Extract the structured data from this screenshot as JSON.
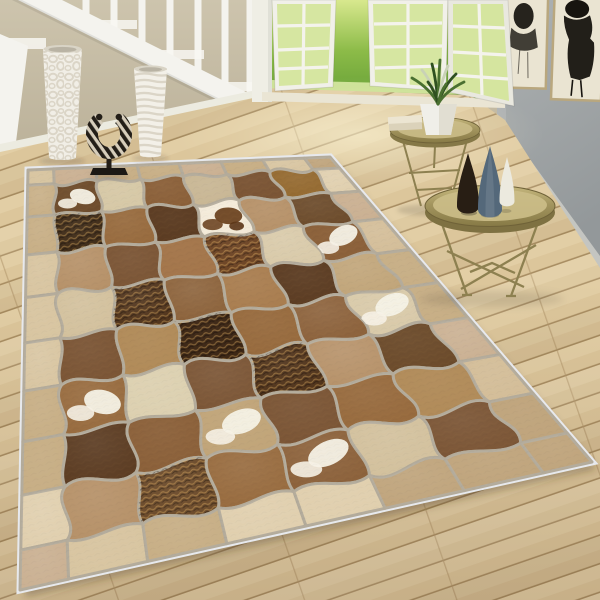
{
  "scene": {
    "description": "Bright living room: white staircase at left with two white floor vases and a zebra-print sculpture, open french doors to a sunny garden, gray gallery wall with two black-ink artworks, two brass tray side tables with vases and a potted plant, and a large brown patchwork cowhide rug laid diagonally on light wood plank flooring",
    "walls": {
      "left_top": "#cdc4ad",
      "left_bottom": "#b6ac94",
      "right_top": "#aeb2b3",
      "right_bottom": "#93989a",
      "baseboard": "#ecebe0"
    },
    "stairs": {
      "paint": "#f4f3ee",
      "step_highlight": "#f8f7f2",
      "baluster_count": 7
    },
    "floor": {
      "plank_mid": "#dcc69b",
      "plank_light": "#e7d4ac",
      "seam": "#a98e63",
      "joint": "#b2976c"
    },
    "doorway": {
      "casing": "#efeee5",
      "frame": "#f1f0e9",
      "frame_shaded": "#e9e8df",
      "muntin": "#f4f3ec",
      "glass_tint": "#cfe48f",
      "threshold": "#eae5d4"
    },
    "garden": {
      "grass_top": "#d8e88e",
      "grass_mid": "#8cbb48",
      "grass_bottom": "#639e35",
      "grass_glow": "#e3f0ae",
      "leaf": "#46702a",
      "flower_colors": [
        "#f6f1de",
        "#f0d98c",
        "#e8a96a",
        "#db8752"
      ]
    },
    "artworks": {
      "frame": "#b9a77e",
      "paper": "#eae4d2",
      "ink": "#17140f"
    },
    "tables": {
      "metal_light": "#c6b87e",
      "metal_mid": "#a3955f",
      "metal_dark": "#877a46",
      "rim_shadow": "#6f6238",
      "tray_inner": "#cbbd88",
      "leg": "#8d8050"
    },
    "decor": {
      "vase_pebble": "#f1eee6",
      "vase_ribbed": "#f3f0e8",
      "vase_mouth": "#d9d4c6",
      "sculpture_dark": "#231e18",
      "sculpture_stripe": "#d6cdbb",
      "stand": "#1c1814",
      "pot": "#f0efe9",
      "pot_shade": "#dcd8ca",
      "book_top": "#ece5d2",
      "book_bottom": "#dbd2ba",
      "plant_green": "#4a7030",
      "plant_dark": "#2f5020",
      "plant_pale": "#c9d2b6",
      "vase_dark": "#281e14",
      "vase_blue": "#54687a",
      "vase_white": "#eceadf"
    },
    "rug": {
      "binding": "#e7e9ed",
      "seam": "#b3ab9b",
      "quad": {
        "tl": [
          28,
          170
        ],
        "tr": [
          330,
          157
        ],
        "br": [
          592,
          462
        ],
        "bl": [
          20,
          590
        ]
      },
      "border_palette": [
        "#d8c5a1",
        "#cab092",
        "#e0cfae",
        "#bfa47c",
        "#d3bd98",
        "#c7ae85"
      ],
      "field": [
        [
          "#6e4c2c",
          "#d6c8a6",
          "#8a5f38",
          "#c8b694",
          "#7a5434",
          "#93682e"
        ],
        [
          "#3e2a16",
          "#96693c",
          "#5a3a20",
          "#f3ead8",
          "#b59067",
          "#6b4a2a"
        ],
        [
          "#b59067",
          "#7a5434",
          "#a3754a",
          "#6b4222",
          "#d8c9a8",
          "#8a5f38"
        ],
        [
          "#d2c09c",
          "#4e3118",
          "#8a6038",
          "#a87c4e",
          "#5a3a20",
          "#c0a478"
        ],
        [
          "#7a5434",
          "#b08a58",
          "#3c2614",
          "#96693c",
          "#8a5f38",
          "#d8c9a8"
        ],
        [
          "#96693c",
          "#dcd0b0",
          "#7a5434",
          "#4e3118",
          "#b59067",
          "#6b4a2a"
        ],
        [
          "#5a3a20",
          "#8a5f38",
          "#c0a478",
          "#7a5434",
          "#96693c",
          "#b08a58"
        ],
        [
          "#b59067",
          "#6b4a2a",
          "#96693c",
          "#8a5f38",
          "#d2c09c",
          "#7a5434"
        ]
      ],
      "textured_cells": [
        [
          1,
          0
        ],
        [
          2,
          3
        ],
        [
          3,
          1
        ],
        [
          4,
          2
        ],
        [
          5,
          3
        ],
        [
          7,
          1
        ]
      ],
      "spotted_cells": [
        [
          0,
          0
        ],
        [
          2,
          5
        ],
        [
          4,
          5
        ],
        [
          5,
          0
        ],
        [
          6,
          2
        ],
        [
          7,
          3
        ]
      ],
      "brown_spotted_cells": [
        [
          1,
          3
        ]
      ],
      "spot_white": "#f6f2e7",
      "spot_brown": "#6d4522"
    }
  }
}
